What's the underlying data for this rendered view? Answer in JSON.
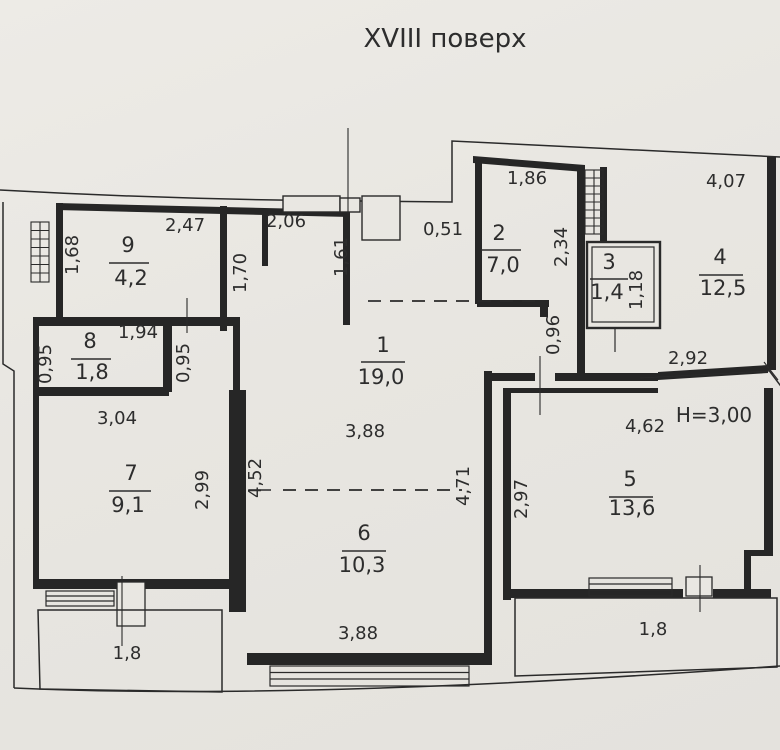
{
  "title": "XVIII поверх",
  "plan": {
    "floor_height_note": "H=3,00",
    "rooms": [
      {
        "number": "1",
        "area": "19,0"
      },
      {
        "number": "2",
        "area": "7,0"
      },
      {
        "number": "3",
        "area": "1,4"
      },
      {
        "number": "4",
        "area": "12,5"
      },
      {
        "number": "5",
        "area": "13,6"
      },
      {
        "number": "6",
        "area": "10,3"
      },
      {
        "number": "7",
        "area": "9,1"
      },
      {
        "number": "8",
        "area": "1,8"
      },
      {
        "number": "9",
        "area": "4,2"
      }
    ],
    "dimensions": [
      {
        "id": "d168",
        "value": "1,68"
      },
      {
        "id": "d247",
        "value": "2,47"
      },
      {
        "id": "d206",
        "value": "2,06"
      },
      {
        "id": "d170",
        "value": "1,70"
      },
      {
        "id": "d161",
        "value": "1,61"
      },
      {
        "id": "d051",
        "value": "0,51"
      },
      {
        "id": "d186",
        "value": "1,86"
      },
      {
        "id": "d234",
        "value": "2,34"
      },
      {
        "id": "d118",
        "value": "1,18"
      },
      {
        "id": "d407",
        "value": "4,07"
      },
      {
        "id": "d096",
        "value": "0,96"
      },
      {
        "id": "d292",
        "value": "2,92"
      },
      {
        "id": "d462",
        "value": "4,62"
      },
      {
        "id": "d297",
        "value": "2,97"
      },
      {
        "id": "d388a",
        "value": "3,88"
      },
      {
        "id": "d452",
        "value": "4,52"
      },
      {
        "id": "d471",
        "value": "4,71"
      },
      {
        "id": "d095l",
        "value": "0,95"
      },
      {
        "id": "d194",
        "value": "1,94"
      },
      {
        "id": "d095r",
        "value": "0,95"
      },
      {
        "id": "d304",
        "value": "3,04"
      },
      {
        "id": "d299",
        "value": "2,99"
      },
      {
        "id": "d388b",
        "value": "3,88"
      },
      {
        "id": "d18l",
        "value": "1,8"
      },
      {
        "id": "d18r",
        "value": "1,8"
      }
    ]
  }
}
